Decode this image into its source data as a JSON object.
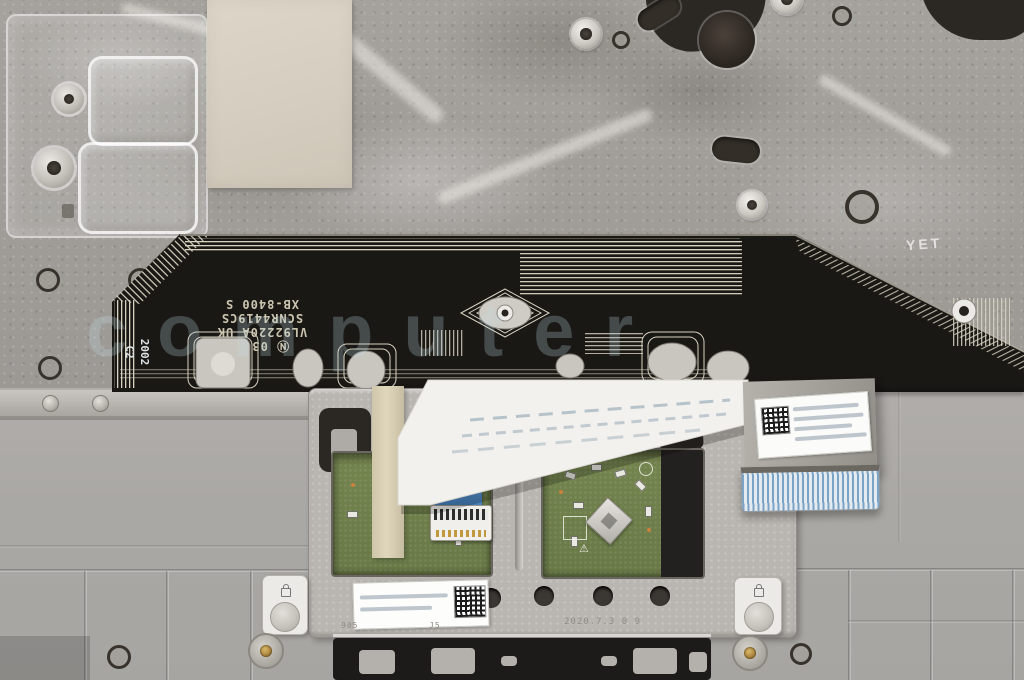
{
  "scene": {
    "subject": "Laptop palmrest / touchpad assembly internal view",
    "watermark_text": "computer"
  },
  "membrane": {
    "line1": "VL92220A UK",
    "line2": "SCNR4419CS",
    "line3": "XB-8400 S",
    "cert": "Ⓝ 03 ∫",
    "side1": "2002",
    "side2": "C2"
  },
  "plate": {
    "etched": "YET"
  },
  "touchpad": {
    "tp": "TP",
    "mark_905": "905",
    "mark_j5": "J5",
    "date_stamp": "2020.7.3  0 9",
    "warning": "⚠"
  },
  "colors": {
    "pcb_green": "#6f7e4b",
    "cable_blue": "#4a86c6",
    "trace_cream": "#d8d2c0",
    "membrane_black": "#1a1815",
    "metal_gray": "#a09d99",
    "plastic_gray": "#acaaa6",
    "bracket_gray": "#b9b5b0",
    "sticker_tan": "#d9d2c4",
    "brass": "#a8823c"
  }
}
